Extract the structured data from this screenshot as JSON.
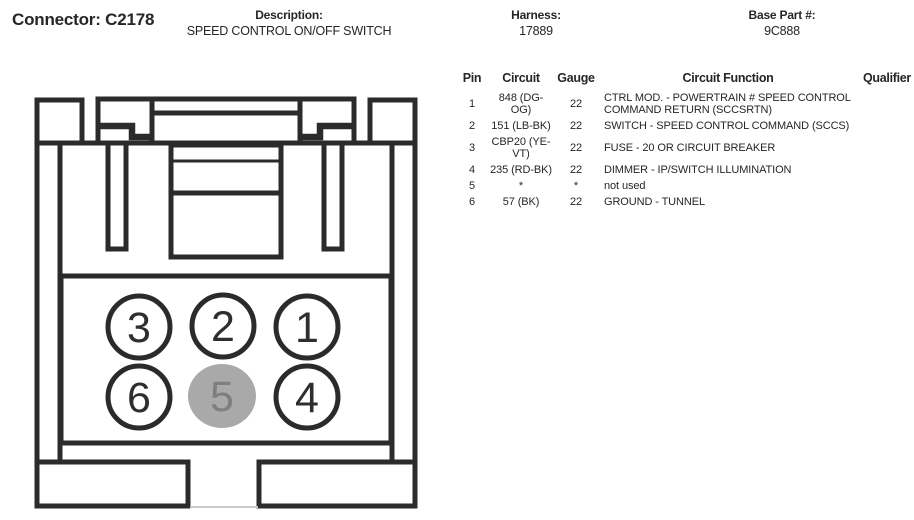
{
  "header": {
    "connector_label": "Connector: C2178",
    "description_label": "Description:",
    "description_value": "SPEED CONTROL ON/OFF SWITCH",
    "harness_label": "Harness:",
    "harness_value": "17889",
    "base_part_label": "Base Part #:",
    "base_part_value": "9C888"
  },
  "table": {
    "columns": [
      "Pin",
      "Circuit",
      "Gauge",
      "Circuit Function",
      "Qualifier"
    ],
    "rows": [
      {
        "pin": "1",
        "circuit": "848 (DG-\nOG)",
        "gauge": "22",
        "function": "CTRL MOD. - POWERTRAIN # SPEED CONTROL\nCOMMAND RETURN (SCCSRTN)",
        "qualifier": ""
      },
      {
        "pin": "2",
        "circuit": "151 (LB-BK)",
        "gauge": "22",
        "function": "SWITCH - SPEED CONTROL COMMAND (SCCS)",
        "qualifier": ""
      },
      {
        "pin": "3",
        "circuit": "CBP20 (YE-\nVT)",
        "gauge": "22",
        "function": "FUSE - 20 OR CIRCUIT BREAKER",
        "qualifier": ""
      },
      {
        "pin": "4",
        "circuit": "235 (RD-BK)",
        "gauge": "22",
        "function": "DIMMER - IP/SWITCH ILLUMINATION",
        "qualifier": ""
      },
      {
        "pin": "5",
        "circuit": "*",
        "gauge": "*",
        "function": "not used",
        "qualifier": ""
      },
      {
        "pin": "6",
        "circuit": "57 (BK)",
        "gauge": "22",
        "function": "GROUND - TUNNEL",
        "qualifier": ""
      }
    ]
  },
  "connector_view": {
    "pins": [
      {
        "label": "3",
        "filled": false
      },
      {
        "label": "2",
        "filled": false
      },
      {
        "label": "1",
        "filled": false
      },
      {
        "label": "6",
        "filled": false
      },
      {
        "label": "5",
        "filled": true
      },
      {
        "label": "4",
        "filled": false
      }
    ],
    "colors": {
      "line": "#2b2b2b",
      "unused_fill": "#a9a9a9",
      "unused_text": "#7f7f7f"
    }
  }
}
